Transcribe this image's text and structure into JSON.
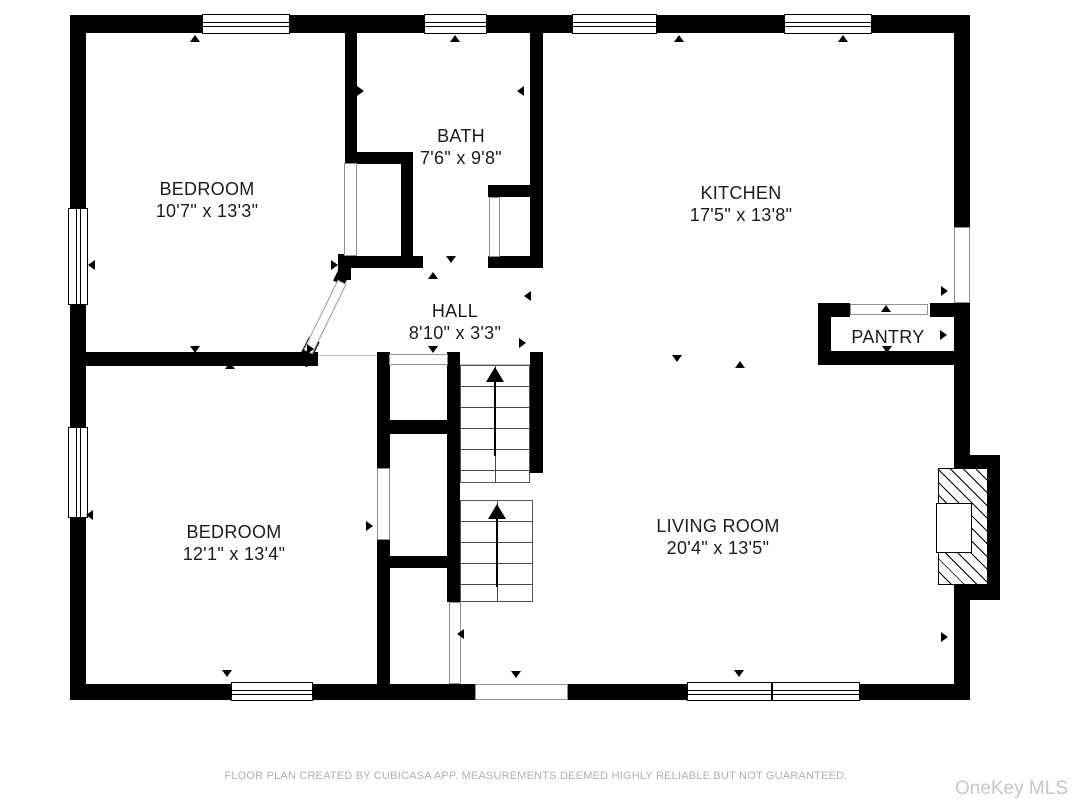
{
  "floorplan": {
    "rooms": [
      {
        "name": "BEDROOM",
        "dims": "10'7\" x 13'3\""
      },
      {
        "name": "BATH",
        "dims": "7'6\" x 9'8\""
      },
      {
        "name": "KITCHEN",
        "dims": "17'5\" x 13'8\""
      },
      {
        "name": "HALL",
        "dims": "8'10\" x 3'3\""
      },
      {
        "name": "PANTRY",
        "dims": "5'4\" x 4'7\""
      },
      {
        "name": "BEDROOM",
        "dims": "12'1\" x 13'4\""
      },
      {
        "name": "LIVING ROOM",
        "dims": "20'4\" x 13'5\""
      }
    ],
    "colors": {
      "wall": "#000000",
      "floor": "#ffffff",
      "label_text": "#1c1c1c",
      "footer_text": "#b0b0b0",
      "watermark_text": "#c7c7c7"
    }
  },
  "footer": {
    "disclaimer": "FLOOR PLAN CREATED BY CUBICASA APP. MEASUREMENTS DEEMED HIGHLY RELIABLE BUT NOT GUARANTEED."
  },
  "watermark": "OneKey MLS"
}
